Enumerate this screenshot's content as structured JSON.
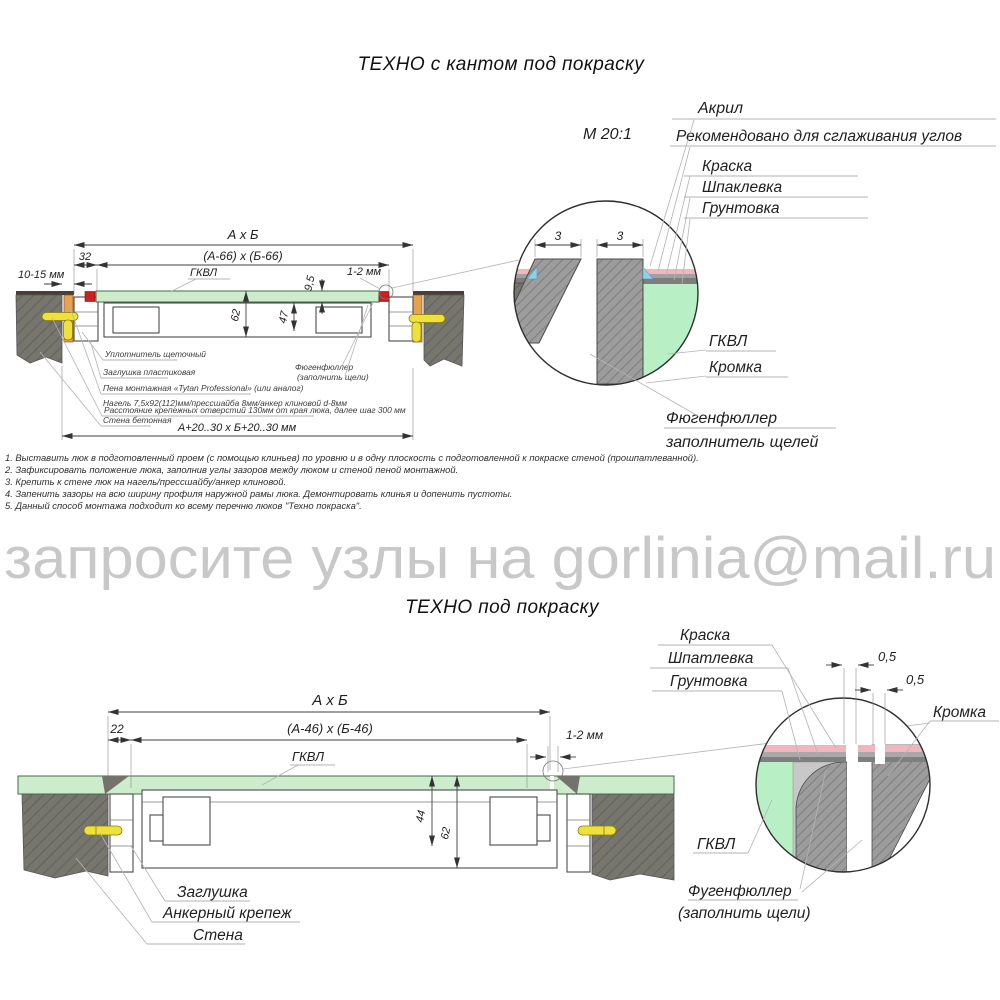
{
  "titles": {
    "top": "ТЕХНО с кантом под покраску",
    "bottom": "ТЕХНО под покраску"
  },
  "watermark": "запросите узлы на gorlinia@mail.ru",
  "top_drawing": {
    "dim_overall": "А х Б",
    "dim_inner": "(А-66) х (Б-66)",
    "dim_32": "32",
    "dim_wall_gap": "10-15 мм",
    "dim_panel": "9,5",
    "dim_edge_gap": "1-2 мм",
    "dim_62": "62",
    "dim_47": "47",
    "dim_opening": "А+20..30 х Б+20..30 мм",
    "label_gkvl": "ГКВЛ",
    "label_seal": "Уплотнитель щеточный",
    "label_plug": "Заглушка пластиковая",
    "label_foam": "Пена монтажная «Tytan Professional» (или аналог)",
    "label_dowel": "Нагель 7,5х92(112)мм/прессшайба 8мм/анкер клиновой d-8мм",
    "label_spacing": "Расстояние крепежных отверстий 130мм от края люка, далее шаг 300 мм",
    "label_wall": "Стена бетонная",
    "label_filler1": "Фюгенфюллер",
    "label_filler2": "(заполнить щели)"
  },
  "top_detail": {
    "scale": "М 20:1",
    "dim_left": "3",
    "dim_right": "3",
    "label_acryl": "Акрил",
    "label_acryl_note": "Рекомендовано для сглаживания углов",
    "label_paint": "Краска",
    "label_putty": "Шпаклевка",
    "label_primer": "Грунтовка",
    "label_gkvl": "ГКВЛ",
    "label_edge": "Кромка",
    "label_filler1": "Фюгенфюллер",
    "label_filler2": "заполнитель щелей"
  },
  "notes": [
    "1. Выставить люк в подготовленный проем (с помощью клиньев) по уровню и в одну плоскость с подготовленной к покраске стеной (прошпатлеванной).",
    "2. Зафиксировать положение люка, заполнив углы зазоров между люком и стеной пеной монтажной.",
    "3. Крепить к стене люк на нагель/прессшайбу/анкер клиновой.",
    "4. Запенить зазоры на всю ширину профиля наружной рамы люка. Демонтировать клинья и допенить пустоты.",
    "5. Данный способ монтажа подходит ко всему перечню люков \"Техно покраска\"."
  ],
  "bottom_drawing": {
    "dim_overall": "А х Б",
    "dim_inner": "(А-46) х (Б-46)",
    "dim_22": "22",
    "dim_edge_gap": "1-2 мм",
    "dim_44": "44",
    "dim_62": "62",
    "label_gkvl": "ГКВЛ",
    "label_plug": "Заглушка",
    "label_anchor": "Анкерный крепеж",
    "label_wall": "Стена"
  },
  "bottom_detail": {
    "dim_gap1": "0,5",
    "dim_gap2": "0,5",
    "label_paint": "Краска",
    "label_putty": "Шпатлевка",
    "label_primer": "Грунтовка",
    "label_edge": "Кромка",
    "label_gkvl": "ГКВЛ",
    "label_filler1": "Фугенфюллер",
    "label_filler2": "(заполнить щели)"
  },
  "colors": {
    "wall_gray": "#76766e",
    "panel_green": "#cdeccb",
    "detail_green": "#b9efc4",
    "wedge_orange": "#e6a24e",
    "anchor_yellow": "#efe13b",
    "gasket_red": "#cc2020",
    "paint_pink": "#f0b6bd",
    "acryl_blue": "#8fcfe8",
    "watermark_gray": "#c8c8c8"
  }
}
